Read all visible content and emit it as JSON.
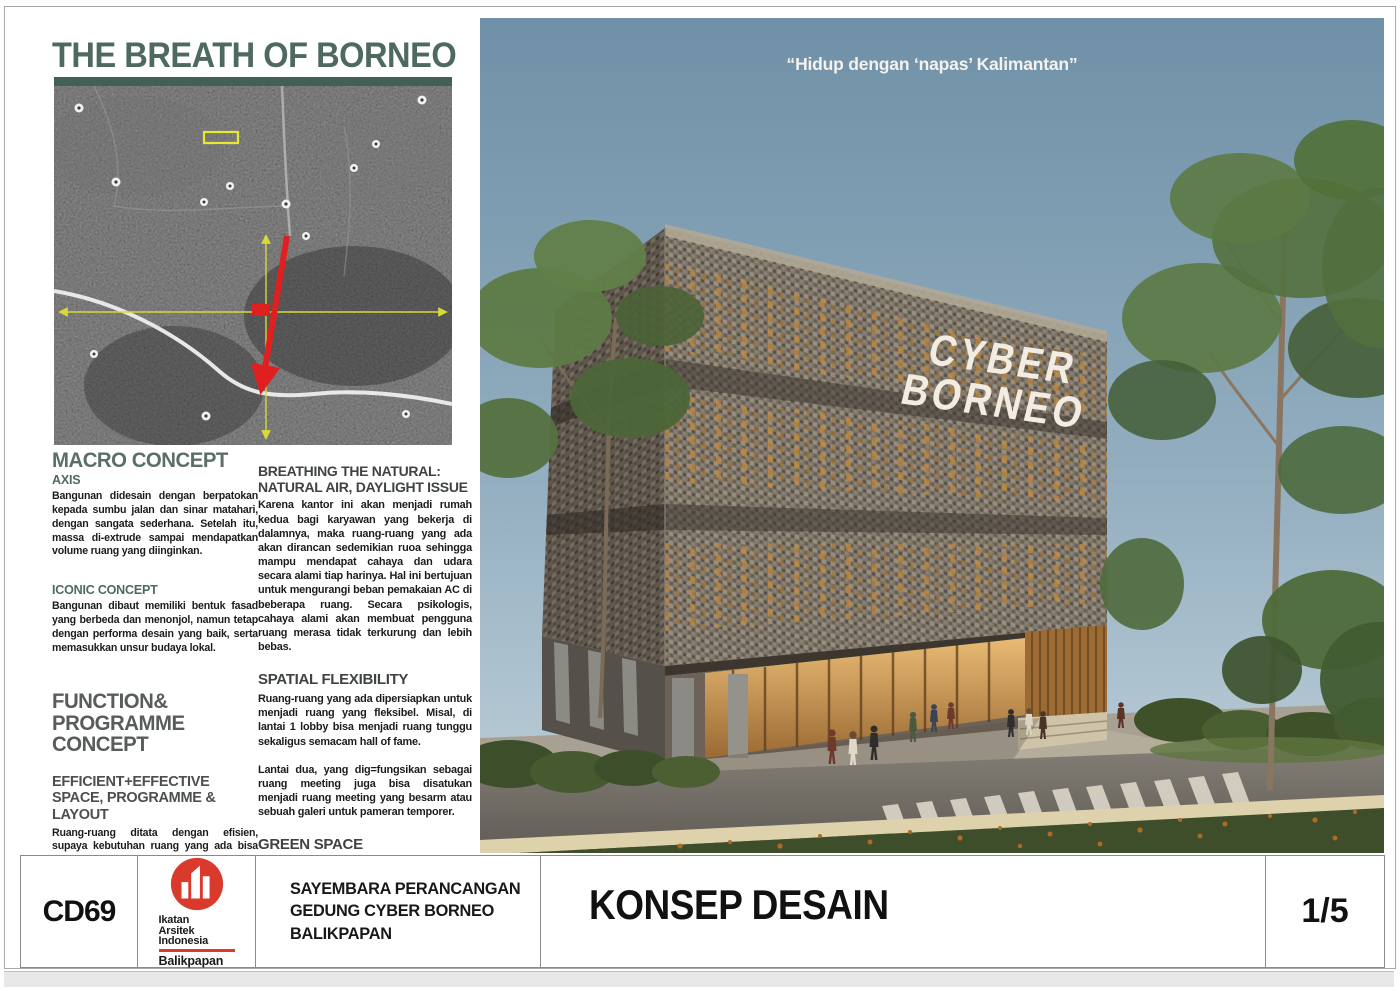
{
  "board": {
    "title": "THE BREATH OF BORNEO",
    "quote": "“Hidup dengan ‘napas’ Kalimantan”",
    "signage": {
      "line1": "CYBER",
      "line2": "BORNEO"
    }
  },
  "left_column": {
    "macro": {
      "heading": "MACRO CONCEPT",
      "axis_heading": "AXIS",
      "axis_body": "Bangunan didesain dengan berpatokan kepada sumbu jalan dan sinar matahari, dengan sangata sederhana. Setelah itu, massa di-extrude sampai mendapatkan volume ruang yang diinginkan.",
      "iconic_heading": "ICONIC CONCEPT",
      "iconic_body": "Bangunan dibaut memiliki bentuk fasad yang berbeda dan menonjol, namun tetap dengan performa desain yang baik, serta memasukkan unsur budaya lokal."
    },
    "function": {
      "heading": "FUNCTION& PROGRAMME CONCEPT",
      "sub": "EFFICIENT+EFFECTIVE SPACE, PROGRAMME & LAYOUT",
      "body": "Ruang-ruang ditata dengan efisien, supaya kebutuhan ruang yang ada bisa ditampung dengan maksimal. Maksimalisasi area yang bisa dibangun, serta penyusunan area sirkulasi yang efektif, mengingat kebutuhan ruang yang banyak dan padat."
    }
  },
  "right_column": {
    "breathing": {
      "heading": "BREATHING THE NATURAL: NATURAL AIR, DAYLIGHT ISSUE",
      "body": "Karena kantor ini akan menjadi rumah kedua bagi karyawan yang bekerja di dalamnya, maka ruang-ruang yang ada akan dirancan sedemikian ruoa sehingga mampu mendapat cahaya dan udara secara alami tiap harinya. Hal ini bertujuan untuk mengurangi beban pemakaian AC di beberapa ruang. Secara psikologis, cahaya alami akan membuat pengguna ruang merasa tidak terkurung dan lebih bebas."
    },
    "spatial": {
      "heading": "SPATIAL FLEXIBILITY",
      "body1": "Ruang-ruang yang ada dipersiapkan untuk menjadi ruang yang fleksibel. Misal, di lantai 1 lobby bisa menjadi ruang tunggu sekaligus semacam hall of fame.",
      "body2": "Lantai dua, yang dig=fungsikan sebagai ruang meeting juga bisa disatukan menjadi ruang meeting yang besarm atau sebuah galeri untuk pameran temporer."
    },
    "green": {
      "heading": "GREEN SPACE",
      "body": "Area hijau diperbanyak dengan membuat atap hijau. Hal ini juga dipercaya mampu menurunkan suhu ruang yang berada di bawahnya. Di samping itu, ruang ini juga bisa dioakai sebagai ruang untuk acara bersama, untuk mengganti ruang yang sudah dimakan oleh bangunan ini."
    }
  },
  "title_bar": {
    "code": "CD69",
    "logo": {
      "line1": "Ikatan",
      "line2": "Arsitek",
      "line3": "Indonesia",
      "line4": "Balikpapan"
    },
    "competition": "SAYEMBARA PERANCANGAN GEDUNG CYBER BORNEO BALIKPAPAN",
    "sheet_title": "KONSEP DESAIN",
    "page_number": "1/5"
  },
  "colors": {
    "title_teal": "#4e6a60",
    "underline_teal": "#425f58",
    "logo_red": "#d93a2b",
    "sky_top": "#6f90a7",
    "sky_bottom": "#c2d3db",
    "facade_taupe": "#7b7265",
    "accent_amber": "#c08a3e",
    "map_axis_red": "#e02020",
    "map_axis_yellow": "#d8d83a",
    "map_site_yellow": "#e8e832"
  }
}
